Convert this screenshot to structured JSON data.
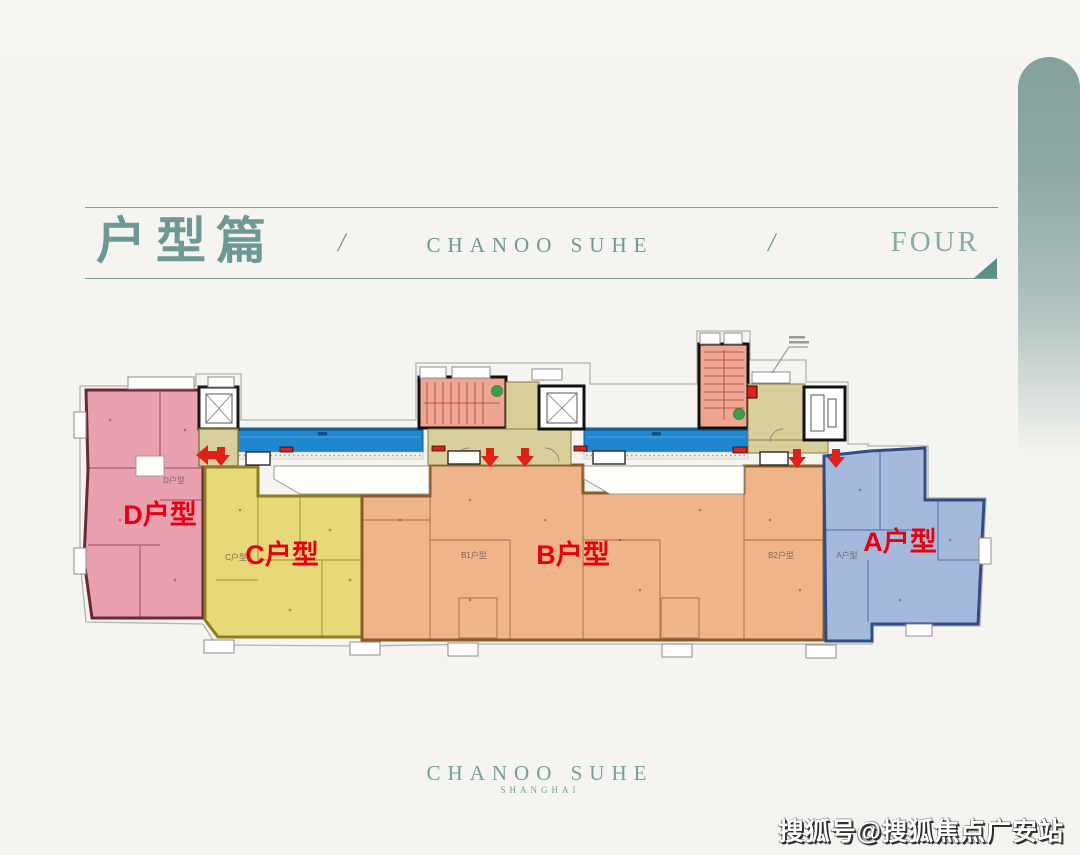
{
  "header": {
    "title": "户型篇",
    "separator_left": "/",
    "brand": "CHANOO SUHE",
    "separator_right": "/",
    "chapter": "FOUR"
  },
  "floorplan": {
    "units": [
      {
        "id": "unit-d",
        "label": "D户型",
        "tiny_label": "D户型"
      },
      {
        "id": "unit-c",
        "label": "C户型",
        "tiny_label": "C户型"
      },
      {
        "id": "unit-b",
        "label": "B户型",
        "tiny_label_1": "B1户型",
        "tiny_label_2": "B2户型"
      },
      {
        "id": "unit-a",
        "label": "A户型",
        "tiny_label": "A户型"
      }
    ],
    "colors": {
      "unit_d": "#e9a0af",
      "unit_c": "#e7d977",
      "unit_b": "#f0b489",
      "unit_a": "#a5b9dd",
      "corridor": "#1f86d0",
      "lobby": "#d9cf9d",
      "stair": "#efa58f",
      "label_red": "#e60012",
      "arrow_red": "#e2201a",
      "exit_green": "#3aa146"
    }
  },
  "footer": {
    "brand": "CHANOO SUHE",
    "subtitle": "SHANGHAI"
  },
  "watermark": {
    "text": "搜狐号@搜狐焦点广安站"
  }
}
